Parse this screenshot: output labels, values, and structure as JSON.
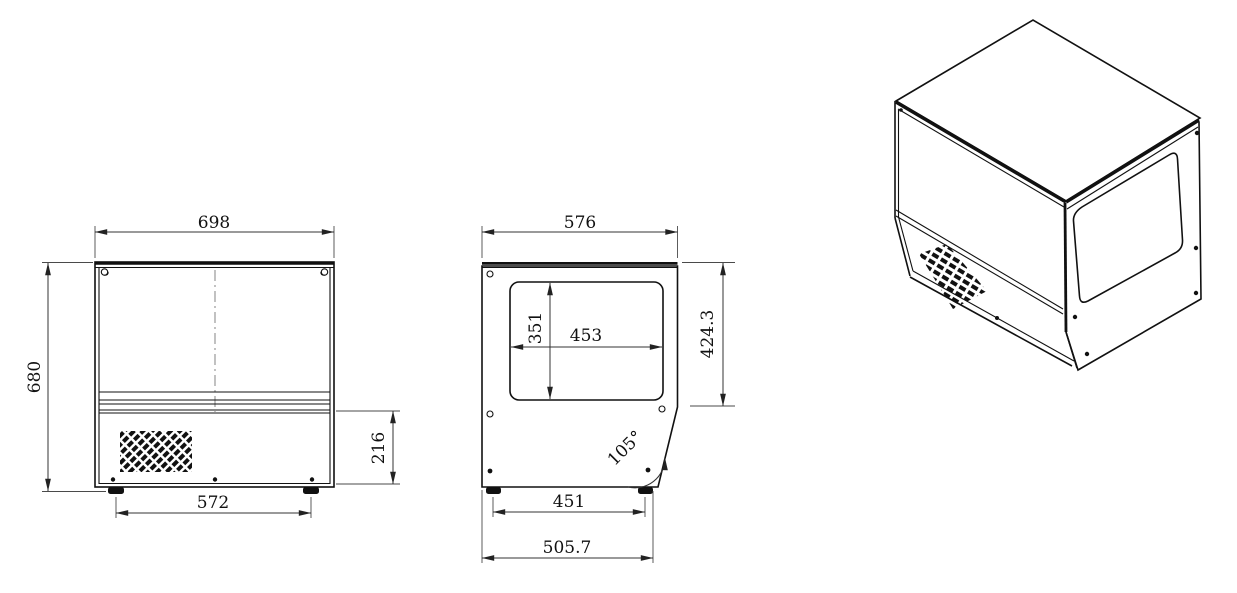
{
  "colors": {
    "background": "#ffffff",
    "line": "#111111"
  },
  "views": {
    "front": {
      "width": "698",
      "height": "680",
      "base_height": "216",
      "foot_span": "572"
    },
    "side": {
      "depth": "576",
      "window_width": "453",
      "window_height": "351",
      "upper_height": "424.3",
      "corner_angle": "105°",
      "foot_span": "451",
      "base_depth": "505.7"
    }
  }
}
